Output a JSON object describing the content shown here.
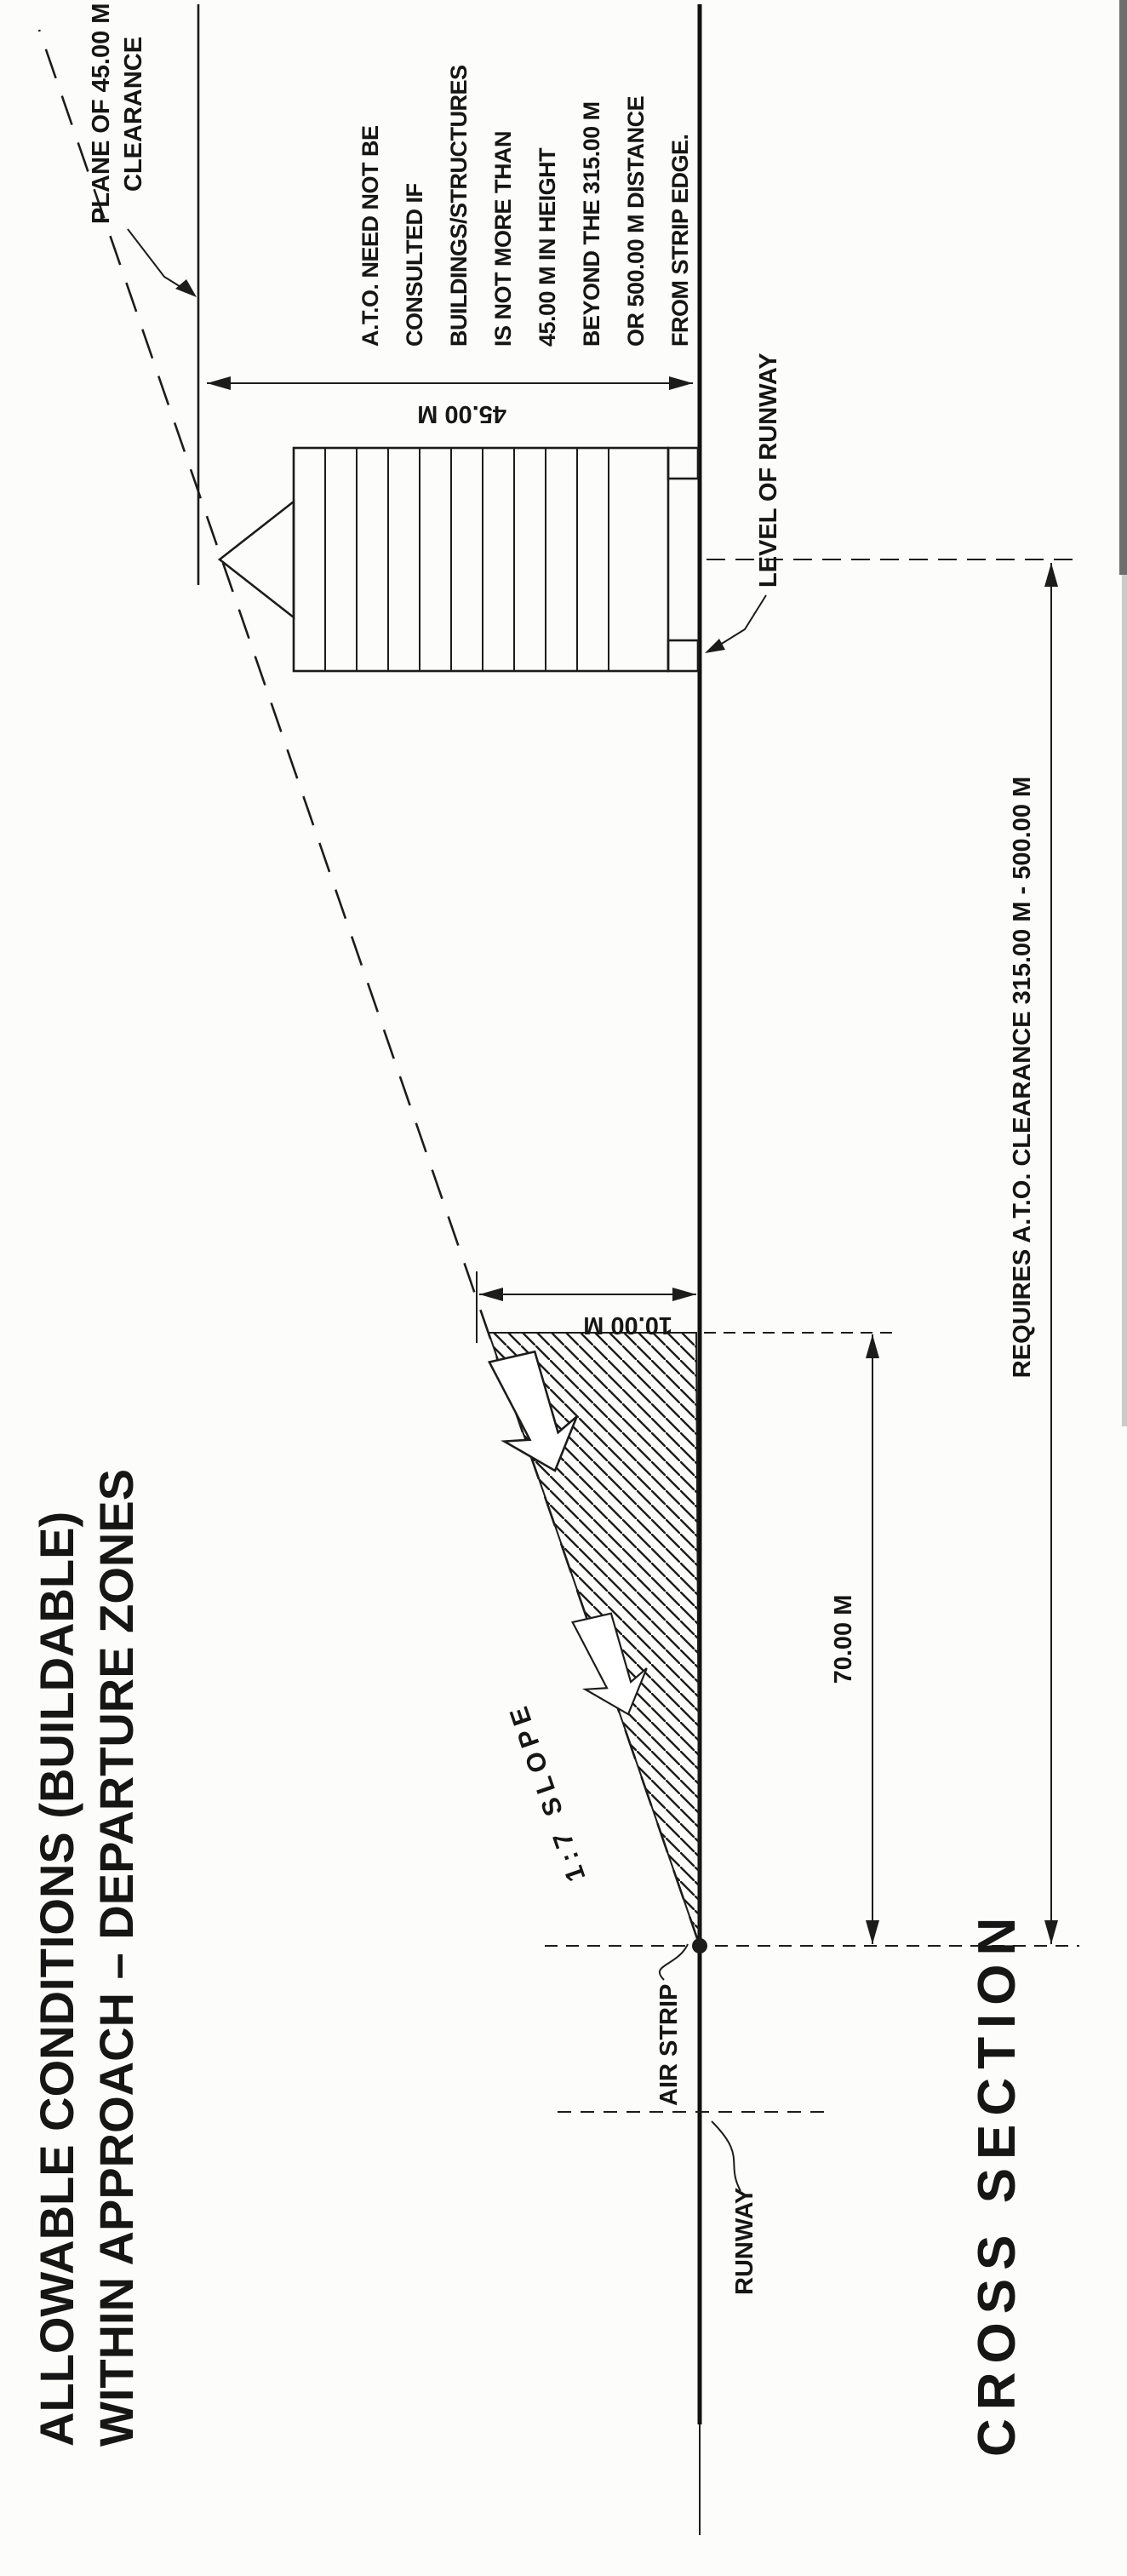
{
  "title": {
    "line1": "ALLOWABLE CONDITIONS (BUILDABLE)",
    "line2": "WITHIN APPROACH – DEPARTURE ZONES"
  },
  "drawing_caption": "CROSS SECTION",
  "labels": {
    "plane_clearance_line1": "PLANE OF 45.00 M",
    "plane_clearance_line2": "CLEARANCE",
    "slope": "1:7  SLOPE",
    "level_of_runway": "LEVEL OF RUNWAY",
    "air_strip": "AIR STRIP",
    "runway": "RUNWAY"
  },
  "note": {
    "lines": [
      "A.T.O. NEED NOT BE",
      "CONSULTED IF",
      "BUILDINGS/STRUCTURES",
      "IS NOT MORE THAN",
      "45.00 M IN HEIGHT",
      "BEYOND THE 315.00 M",
      "OR 500.00 M DISTANCE",
      "FROM STRIP EDGE."
    ]
  },
  "dimensions": {
    "height_45": "45.00 M",
    "height_10": "10.00 M",
    "dist_70": "70.00 M",
    "ato_clearance": "REQUIRES A.T.O. CLEARANCE 315.00 M - 500.00 M"
  },
  "colors": {
    "ink": "#1c1c1c",
    "paper": "#fcfcfa"
  }
}
